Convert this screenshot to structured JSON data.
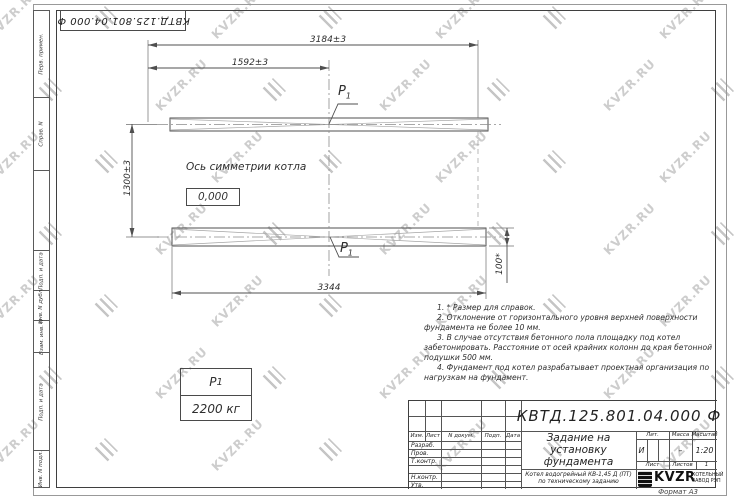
{
  "page": {
    "watermark_text": "KVZR.RU",
    "format": "Формат А3"
  },
  "top_stamp": {
    "text": "КВТД.125.801.04.000  Ф"
  },
  "margin_labels": {
    "perv": "Перв. примен.",
    "sprav": "Справ. N",
    "podp1": "Подп. и дата",
    "inv_dubl": "Инв. N дубл.",
    "vzam": "Взам. инв. N",
    "podp2": "Подп. и дата",
    "inv_podl": "Инв. N подл."
  },
  "drawing": {
    "dim_total": "3184±3",
    "dim_half": "1592±3",
    "dim_height": "1300±3",
    "dim_overall": "3344",
    "dim_pad": "100*",
    "axis_label": "Ось симметрии котла",
    "level_mark": "0,000",
    "load_point": "P",
    "load_point_sub": "1",
    "load_table": {
      "name": "P",
      "name_sub": "1",
      "value": "2200 кг"
    }
  },
  "notes": [
    "1. * Размер для справок.",
    "2. Отклонение от горизонтального уровня верхней поверхности фундамента не более 10 мм.",
    "3. В случае отсутствия бетонного пола площадку под котел забетонировать. Расстояние от осей крайних колонн до края бетонной подушки 500 мм.",
    "4. Фундамент под котел разрабатывает проектная организация по нагрузкам на фундамент."
  ],
  "title_block": {
    "designation": "КВТД.125.801.04.000  Ф",
    "doc_name_line1": "Задание на",
    "doc_name_line2": "установку",
    "doc_name_line3": "фундамента",
    "product_line1": "Котел водогрейный КВ-1,45 Д (ПТ)",
    "product_line2": "по техническому заданию",
    "cols": {
      "izm": "Изм.",
      "list": "Лист",
      "ndok": "N докум.",
      "podp": "Подп.",
      "data": "Дата"
    },
    "rows": {
      "razrab": "Разраб.",
      "prov": "Пров.",
      "tkontr": "Т.контр.",
      "nkontr": "Н.контр.",
      "utv": "Утв."
    },
    "lit_label": "Лит.",
    "lit_value": "И",
    "mass_label": "Масса",
    "mass_value": "–",
    "scale_label": "Масштаб",
    "scale_value": "1:20",
    "sheet_label": "Лист",
    "sheets_label": "Листов",
    "sheets_value": "1",
    "logo_name": "KVZR",
    "company_line1": "КОТЕЛЬНЫЙ",
    "company_line2": "ЗАВОД РЭП"
  }
}
